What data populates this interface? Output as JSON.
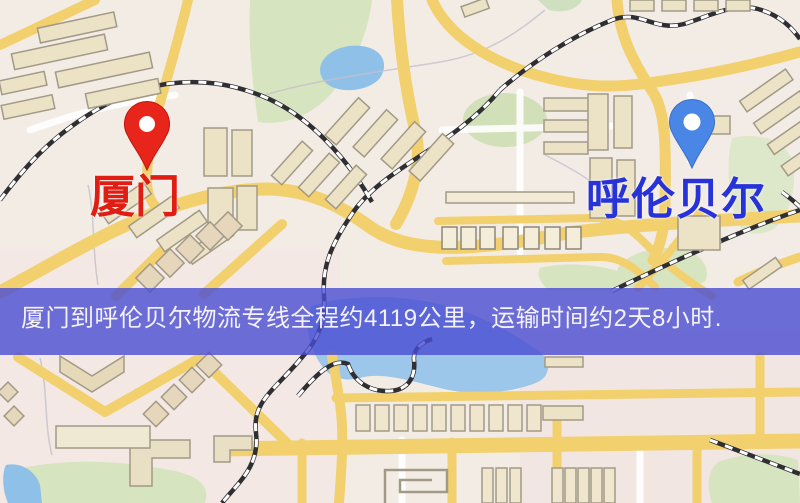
{
  "map": {
    "origin": {
      "name": "厦门",
      "label_color": "#e01d12",
      "pin_color": "#e8251b",
      "pin_icon": "map-pin-red"
    },
    "destination": {
      "name": "呼伦贝尔",
      "label_color": "#2732d8",
      "pin_color": "#4a86e6",
      "pin_icon": "map-pin-blue"
    },
    "banner": {
      "text": "厦门到呼伦贝尔物流专线全程约4119公里，运输时间约2天8小时.",
      "background_color": "#4a4cd2",
      "text_color": "#f4f2f8",
      "distance_km": "4119",
      "duration": "2天8小时"
    },
    "colors": {
      "map_background": "#f3ece5",
      "road_yellow": "#f2d06e",
      "water_blue": "#8fc0e8",
      "park_green": "#d7e4c0",
      "building_tan": "#ece2c6",
      "railway_dark": "#2f2f33"
    }
  }
}
